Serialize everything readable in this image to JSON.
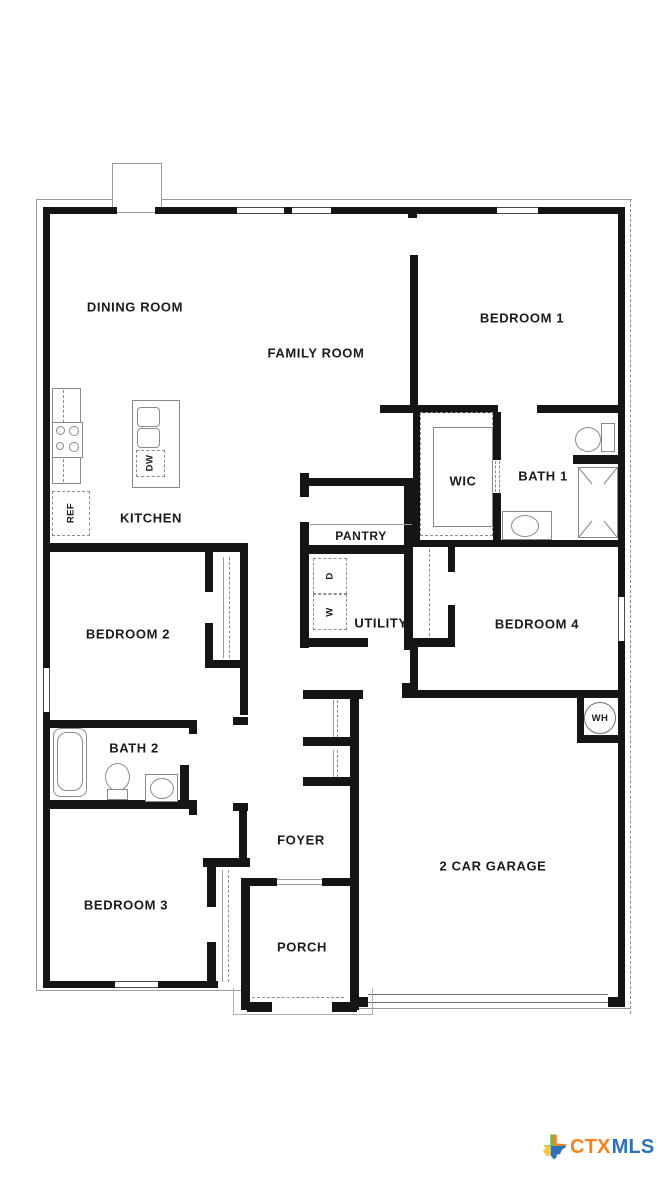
{
  "rooms": {
    "dining_room": {
      "label": "DINING ROOM"
    },
    "family_room": {
      "label": "FAMILY ROOM"
    },
    "bedroom_1": {
      "label": "BEDROOM 1"
    },
    "kitchen": {
      "label": "KITCHEN"
    },
    "wic": {
      "label": "WIC"
    },
    "bath_1": {
      "label": "BATH 1"
    },
    "pantry": {
      "label": "PANTRY"
    },
    "utility": {
      "label": "UTILITY"
    },
    "bedroom_2": {
      "label": "BEDROOM 2"
    },
    "bedroom_4": {
      "label": "BEDROOM 4"
    },
    "bath_2": {
      "label": "BATH 2"
    },
    "foyer": {
      "label": "FOYER"
    },
    "bedroom_3": {
      "label": "BEDROOM 3"
    },
    "garage": {
      "label": "2 CAR GARAGE"
    },
    "porch": {
      "label": "PORCH"
    }
  },
  "fixtures": {
    "refrigerator": {
      "label": "REF"
    },
    "dishwasher": {
      "label": "DW"
    },
    "dryer": {
      "label": "D"
    },
    "washer": {
      "label": "W"
    },
    "water_heater": {
      "label": "WH"
    }
  },
  "branding": {
    "ctx": "CTX",
    "mls": "MLS",
    "ctx_color": "#F58220",
    "mls_color": "#2C72B8"
  },
  "colors": {
    "wall": "#151515",
    "fixture_line": "#8a8a8a"
  }
}
